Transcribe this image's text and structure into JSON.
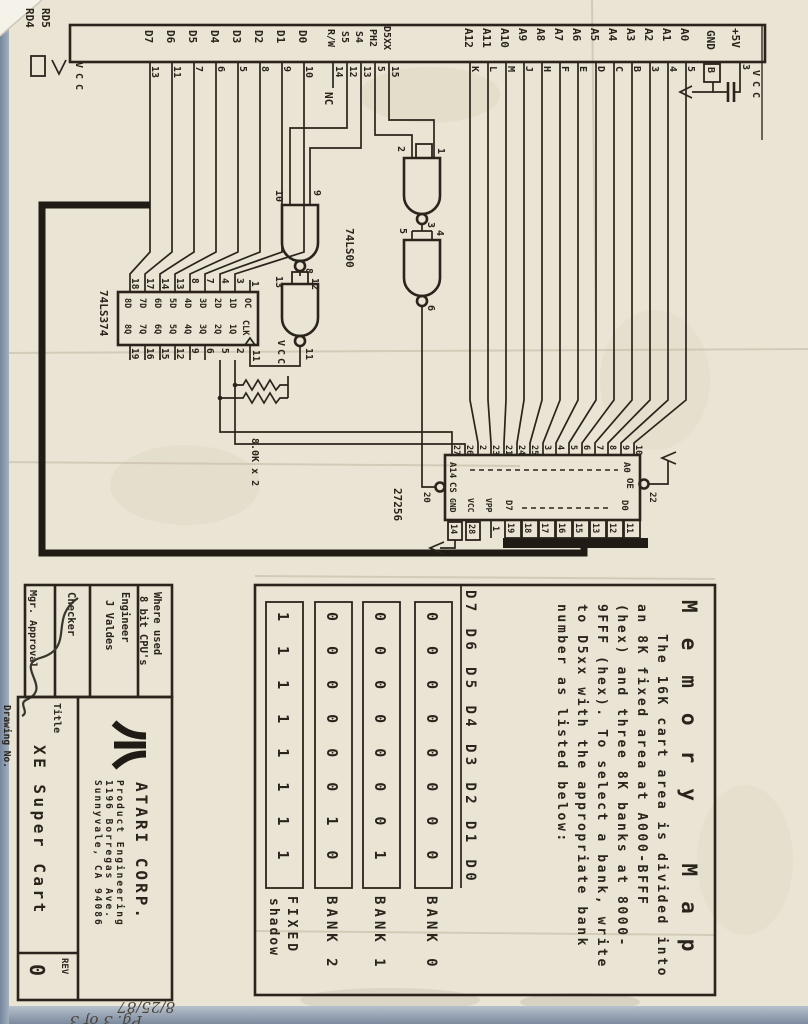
{
  "connector": {
    "rd_labels": [
      "RD4",
      "RD5"
    ],
    "pullup_vcc": "VCC",
    "data_labels": [
      "D7",
      "D6",
      "D5",
      "D4",
      "D3",
      "D2",
      "D1",
      "D0"
    ],
    "data_pins": [
      "13",
      "11",
      "7",
      "6",
      "5",
      "8",
      "9",
      "10"
    ],
    "ctrl_labels": [
      "R/W",
      "S5",
      "S4",
      "PH2",
      "D5XX"
    ],
    "ctrl_pins": [
      "14",
      "12",
      "13",
      "5",
      "15"
    ],
    "nc": "NC",
    "addr_labels": [
      "A12",
      "A11",
      "A10",
      "A9",
      "A8",
      "A7",
      "A6",
      "A5",
      "A4",
      "A3",
      "A2",
      "A1",
      "A0"
    ],
    "addr_pins": [
      "K",
      "L",
      "M",
      "J",
      "H",
      "F",
      "E",
      "D",
      "C",
      "B",
      "3",
      "4",
      "5"
    ],
    "gnd_label": "GND",
    "gnd_pin": "B",
    "plus5_label": "+5V",
    "plus5_pin": "3",
    "cap_vcc": "VCC"
  },
  "latch": {
    "name": "74LS374",
    "top_pins": [
      "18",
      "17",
      "14",
      "13",
      "8",
      "7",
      "4",
      "3",
      "1"
    ],
    "top_cells": [
      "8D",
      "7D",
      "6D",
      "5D",
      "4D",
      "3D",
      "2D",
      "1D",
      "OC"
    ],
    "bottom_cells": [
      "8Q",
      "7Q",
      "6Q",
      "5Q",
      "4Q",
      "3Q",
      "2Q",
      "1Q",
      "CLK"
    ],
    "bottom_pins": [
      "19",
      "16",
      "15",
      "12",
      "9",
      "6",
      "5",
      "2",
      "11"
    ]
  },
  "nand": {
    "name": "74LS00",
    "g1": [
      "2",
      "1",
      "3"
    ],
    "g2": [
      "5",
      "4",
      "6"
    ],
    "g3": [
      "10",
      "9",
      "8"
    ],
    "g4": [
      "13",
      "12",
      "11"
    ]
  },
  "pullups": {
    "value": "8.0K x 2",
    "vcc": "VCC"
  },
  "rom": {
    "name": "27256",
    "a_hi": "A14",
    "a_lo": "A0",
    "oe": "OE",
    "oe_pin": "22",
    "cs": "CS",
    "cs_pin": "20",
    "gnd": "GND",
    "gnd_pin": "14",
    "vcc": "VCC",
    "vcc_pin": "28",
    "vpp": "VPP",
    "vpp_pin": "1",
    "d_hi": "D7",
    "d_lo": "D0",
    "data_pins": [
      "19",
      "18",
      "17",
      "16",
      "15",
      "13",
      "12",
      "11"
    ],
    "top_pins": [
      "27",
      "26",
      "2",
      "23",
      "21",
      "24",
      "25",
      "3",
      "4",
      "5",
      "6",
      "7",
      "8",
      "9",
      "10"
    ]
  },
  "memory_map": {
    "title": "Memory Map",
    "lines": [
      "The 16K cart area is divided into",
      "an 8K fixed area at A000-BFFF",
      "(hex) and three 8K banks at 8000-",
      "9FFF (hex). To select a bank, write",
      "to D5xx with the appropriate bank",
      "number as listed below:"
    ],
    "header": "D7 D6 D5 D4 D3 D2 D1 D0",
    "rows": [
      {
        "bits": "0 0 0 0 0 0 0 0",
        "label": "BANK 0"
      },
      {
        "bits": "0 0 0 0 0 0 0 1",
        "label": "BANK 1"
      },
      {
        "bits": "0 0 0 0 0 0 1 0",
        "label": "BANK 2"
      },
      {
        "bits": "1 1 1 1 1 1 1 1",
        "label": "FIXED",
        "label2": "shadow"
      }
    ]
  },
  "title_block": {
    "where_label": "Where used",
    "where_value": "8 bit CPU's",
    "engineer_label": "Engineer",
    "engineer_value": "J Valdes",
    "checker_label": "Checker",
    "mgr_label": "Mgr. Approval",
    "drawing_label": "Drawing No.",
    "title_label": "Title",
    "title_value": "XE Super Cart",
    "company": "ATARI CORP.",
    "dept": "Product Engineering",
    "addr1": "1196 Borregas Ave.",
    "addr2": "Sunnyvale, CA 94086",
    "rev_label": "REV",
    "rev_value": "0"
  },
  "annotations": {
    "page": "Pg. 3 of 3",
    "date": "8/25/87"
  }
}
